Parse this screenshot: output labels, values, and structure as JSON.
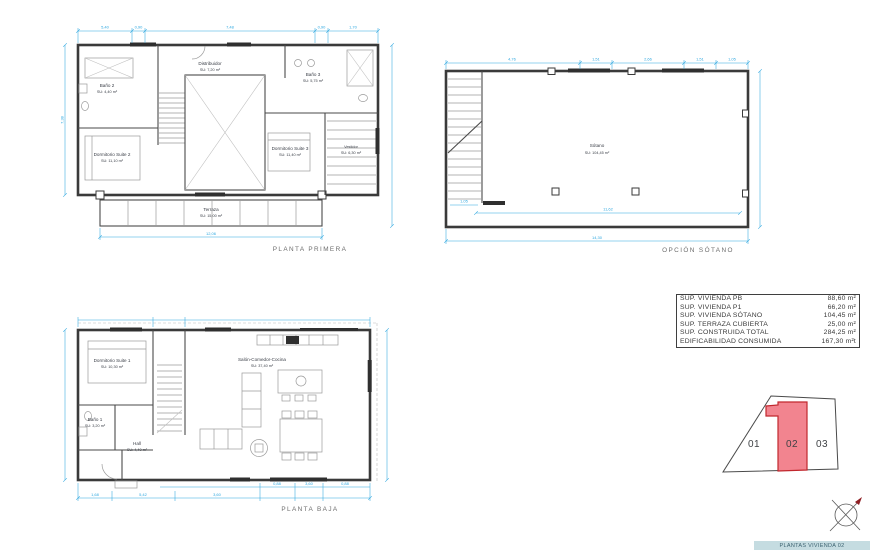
{
  "sheet": {
    "background": "#ffffff"
  },
  "colors": {
    "wall": "#3a3a3a",
    "dimension": "#2fa8e0",
    "room_text": "#3c4049",
    "title_text": "#6d6d6d",
    "plot_highlight_fill": "#f2848f",
    "plot_highlight_stroke": "#c1272d",
    "footer_bar_bg": "#c5dce1"
  },
  "plans": {
    "primera": {
      "title": "PLANTA PRIMERA",
      "rooms": [
        {
          "name": "Baño 2",
          "area": "SU: 4,40 m²"
        },
        {
          "name": "Distribuidor",
          "area": "SU: 7,20 m²"
        },
        {
          "name": "Dormitorio Suite 2",
          "area": "SU: 11,10 m²"
        },
        {
          "name": "Baño 3",
          "area": "SU: 5,75 m²"
        },
        {
          "name": "Dormitorio Suite 3",
          "area": "SU: 11,40 m²"
        },
        {
          "name": "Vestidor",
          "area": "SU: 6,30 m²"
        },
        {
          "name": "Terraza",
          "area": "SU: 15,00 m²"
        }
      ],
      "dims": {
        "top": [
          "5,40",
          "0,90",
          "7,48",
          "0,90",
          "1,70"
        ],
        "left": "7,38",
        "bottom": "12,06"
      }
    },
    "sotano": {
      "title": "OPCIÓN SÓTANO",
      "rooms": [
        {
          "name": "Sótano",
          "area": "SU: 104,45 m²"
        }
      ],
      "dims": {
        "top": [
          "4,76",
          "1,51",
          "2,66",
          "1,51",
          "1,05"
        ],
        "bottom": "14,30",
        "inner": "11,62",
        "left": "1,05"
      }
    },
    "baja": {
      "title": "PLANTA BAJA",
      "rooms": [
        {
          "name": "Dormitorio Suite 1",
          "area": "SU: 10,30 m²"
        },
        {
          "name": "Baño 1",
          "area": "SU: 3,20 m²"
        },
        {
          "name": "Hall",
          "area": "SU: 4,40 m²"
        },
        {
          "name": "Salón-Comedor-Cocina",
          "area": "SU: 37,40 m²"
        }
      ],
      "dims": {
        "bottom": [
          "1,68",
          "5,42",
          "3,60",
          "0,88",
          "3,60",
          "0,88"
        ]
      }
    }
  },
  "summary_table": {
    "rows": [
      {
        "label": "SUP. VIVIENDA PB",
        "value": "88,60 m²"
      },
      {
        "label": "SUP. VIVIENDA P1",
        "value": "66,20 m²"
      },
      {
        "label": "SUP. VIVIENDA SÓTANO",
        "value": "104,45 m²"
      },
      {
        "label": "SUP. TERRAZA CUBIERTA",
        "value": "25,00 m²"
      },
      {
        "label": "SUP. CONSTRUIDA TOTAL",
        "value": "284,25 m²"
      },
      {
        "label": "EDIFICABILIDAD CONSUMIDA",
        "value": "167,30 m²t"
      }
    ]
  },
  "plot_map": {
    "plots": [
      {
        "label": "01"
      },
      {
        "label": "02"
      },
      {
        "label": "03"
      }
    ],
    "highlighted_plot": "02"
  },
  "footer": {
    "label": "PLANTAS VIVIENDA 02"
  }
}
